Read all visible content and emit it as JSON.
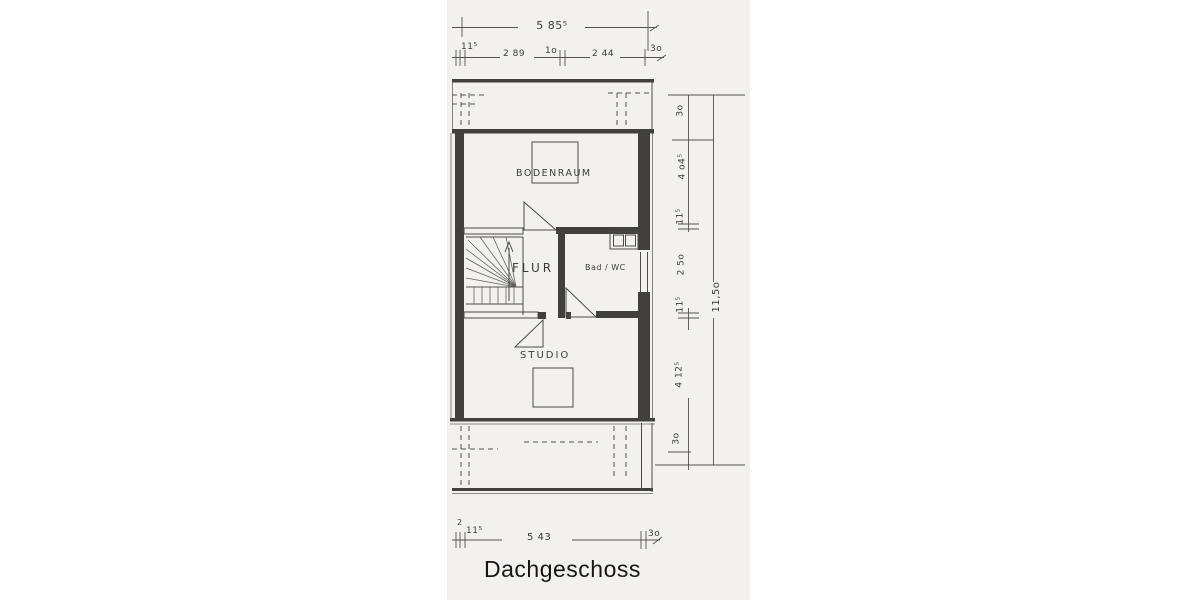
{
  "title": "Dachgeschoss",
  "rooms": {
    "bodenraum": "BODENRAUM",
    "flur": "FLUR",
    "bad": "Bad / WC",
    "studio": "STUDIO"
  },
  "dimensions": {
    "top_total": "5 85⁵",
    "top_chain": {
      "a": "11⁵",
      "b": "2 89",
      "c": "1o",
      "d": "2 44",
      "e": "3o"
    },
    "bottom_chain": {
      "a": "2",
      "b": "11⁵",
      "c": "5 43",
      "d": "3o"
    },
    "right_chain": {
      "a": "3o",
      "b": "4 o4⁵",
      "c": "11⁵",
      "d": "2 5o",
      "e": "11⁵",
      "f": "4 12⁵",
      "g": "3o"
    },
    "right_total": "11,5o"
  },
  "colors": {
    "paper": "#ffffff",
    "scan_background": "#f2f1ee",
    "ink": "#41403d",
    "title_ink": "#161616"
  }
}
